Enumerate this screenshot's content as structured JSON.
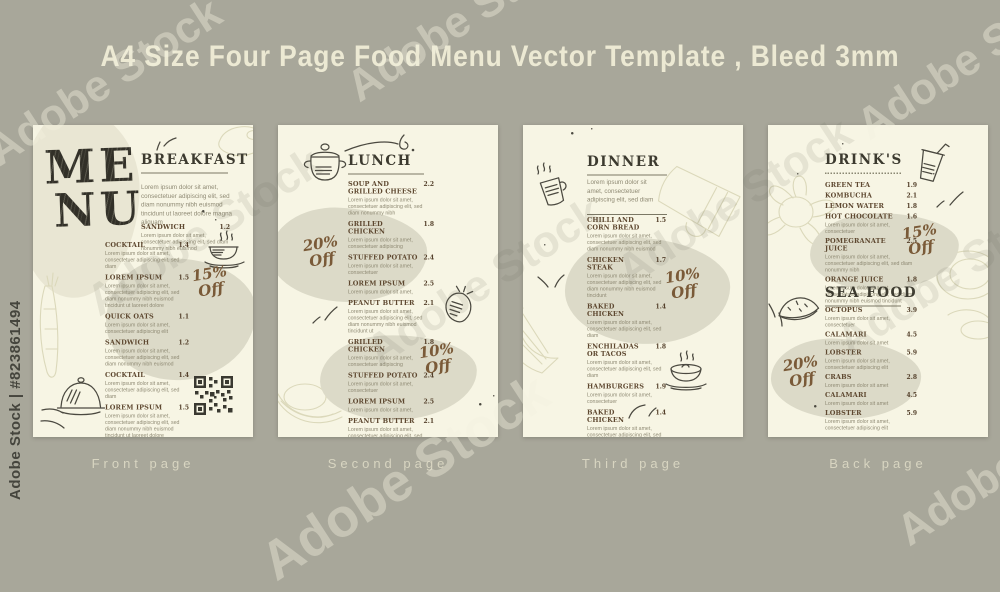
{
  "title": "A4 Size Four Page Food Menu Vector Template , Bleed 3mm",
  "watermark": {
    "stock_id": "Adobe Stock | #823861494",
    "brand": "Adobe Stock"
  },
  "colors": {
    "background": "#a8a79a",
    "page": "#f7f5e4",
    "blob_gray": "#dcdac8",
    "blob_beige": "#e9e6d3",
    "heading": "#3c3a2f",
    "item_name": "#5e4830",
    "body_text": "#8f8a74",
    "handwriting": "#7a5a38",
    "footer_label": "#d8d5c1"
  },
  "footer": {
    "labels": [
      "Front page",
      "Second page",
      "Third page",
      "Back page"
    ]
  },
  "pages": {
    "front": {
      "menu_word": {
        "line1": "ME",
        "line2": "NU"
      },
      "heading": "BREAKFAST",
      "intro": "Lorem ipsum dolor sit amet, consectetuer adipiscing elit, sed diam nonummy nibh euismod tincidunt ut laoreet dolore magna aliquam",
      "discount": {
        "percent": "15%",
        "word": "Off"
      },
      "items": [
        {
          "name": "SANDWICH",
          "price": "1.2",
          "desc": "Lorem ipsum dolor sit amet, consectetuer adipiscing elit, sed diam nonummy nibh euismod"
        },
        {
          "name": "COCKTAIL",
          "price": "1.4",
          "desc": "Lorem ipsum dolor sit amet, consectetuer adipiscing elit, sed diam"
        },
        {
          "name": "LOREM IPSUM",
          "price": "1.5",
          "desc": "Lorem ipsum dolor sit amet, consectetuer adipiscing elit, sed diam nonummy nibh euismod tincidunt ut laoreet dolore"
        },
        {
          "name": "QUICK OATS",
          "price": "1.1",
          "desc": "Lorem ipsum dolor sit amet, consectetuer adipiscing elit"
        },
        {
          "name": "SANDWICH",
          "price": "1.2",
          "desc": "Lorem ipsum dolor sit amet, consectetuer adipiscing elit, sed diam nonummy nibh euismod"
        },
        {
          "name": "COCKTAIL",
          "price": "1.4",
          "desc": "Lorem ipsum dolor sit amet, consectetuer adipiscing elit, sed diam"
        },
        {
          "name": "LOREM IPSUM",
          "price": "1.5",
          "desc": "Lorem ipsum dolor sit amet, consectetuer adipiscing elit, sed diam nonummy nibh euismod tincidunt ut laoreet dolore"
        },
        {
          "name": "QUICK OATS",
          "price": "1.1",
          "desc": "Lorem ipsum dolor sit amet, consectetuer adipiscing elit"
        }
      ],
      "icons": [
        "leaf-marks",
        "coffee-cup",
        "carrot-sketch",
        "cloche",
        "swoosh-marks",
        "qr-code",
        "plate-sketch"
      ]
    },
    "second": {
      "heading": "LUNCH",
      "discount_top": {
        "percent": "20%",
        "word": "Off"
      },
      "discount_bottom": {
        "percent": "10%",
        "word": "Off"
      },
      "items": [
        {
          "name": "SOUP AND GRILLED CHEESE",
          "price": "2.2",
          "desc": "Lorem ipsum dolor sit amet, consectetuer adipiscing elit, sed diam nonummy nibh"
        },
        {
          "name": "GRILLED CHICKEN",
          "price": "1.8",
          "desc": "Lorem ipsum dolor sit amet, consectetuer adipiscing"
        },
        {
          "name": "STUFFED POTATO",
          "price": "2.4",
          "desc": "Lorem ipsum dolor sit amet, consectetuer"
        },
        {
          "name": "LOREM IPSUM",
          "price": "2.5",
          "desc": "Lorem ipsum dolor sit amet,"
        },
        {
          "name": "PEANUT BUTTER",
          "price": "2.1",
          "desc": "Lorem ipsum dolor sit amet, consectetuer adipiscing elit, sed diam nonummy nibh euismod tincidunt ut"
        },
        {
          "name": "GRILLED CHICKEN",
          "price": "1.8",
          "desc": "Lorem ipsum dolor sit amet, consectetuer adipiscing"
        },
        {
          "name": "STUFFED POTATO",
          "price": "2.4",
          "desc": "Lorem ipsum dolor sit amet, consectetuer"
        },
        {
          "name": "LOREM IPSUM",
          "price": "2.5",
          "desc": "Lorem ipsum dolor sit amet,"
        },
        {
          "name": "PEANUT BUTTER",
          "price": "2.1",
          "desc": "Lorem ipsum dolor sit amet, consectetuer adipiscing elit, sed diam nonummy nibh euismod tincidunt ut"
        },
        {
          "name": "STUFFED POTATO",
          "price": "2.4",
          "desc": "Lorem ipsum dolor sit amet, consectetuer"
        }
      ],
      "icons": [
        "cooking-pot",
        "scribble",
        "strawberry",
        "leaf-marks",
        "banana-sketch"
      ]
    },
    "third": {
      "heading": "DINNER",
      "intro": "Lorem ipsum dolor sit amet, consectetuer adipiscing elit, sed diam",
      "discount": {
        "percent": "10%",
        "word": "Off"
      },
      "items": [
        {
          "name": "CHILLI AND CORN BREAD",
          "price": "1.5",
          "desc": "Lorem ipsum dolor sit amet, consectetuer adipiscing elit, sed diam nonummy nibh euismod"
        },
        {
          "name": "CHICKEN STEAK",
          "price": "1.7",
          "desc": "Lorem ipsum dolor sit amet, consectetuer adipiscing elit, sed diam nonummy nibh euismod tincidunt"
        },
        {
          "name": "BAKED CHICKEN",
          "price": "1.4",
          "desc": "Lorem ipsum dolor sit amet, consectetuer adipiscing elit, sed diam"
        },
        {
          "name": "ENCHILADAS OR TACOS",
          "price": "1.8",
          "desc": "Lorem ipsum dolor sit amet, consectetuer adipiscing elit, sed diam"
        },
        {
          "name": "HAMBURGERS",
          "price": "1.9",
          "desc": "Lorem ipsum dolor sit amet, consectetuer"
        },
        {
          "name": "BAKED CHICKEN",
          "price": "1.4",
          "desc": "Lorem ipsum dolor sit amet, consectetuer adipiscing elit, sed diam"
        },
        {
          "name": "ENCHILADAS OR TACOS",
          "price": "1.8",
          "desc": "Lorem ipsum dolor sit amet, consectetuer adipiscing elit, sed diam"
        }
      ],
      "icons": [
        "steaming-mug",
        "mug-sketch",
        "lemon-sketch",
        "teacup",
        "check-marks",
        "swoosh-marks"
      ]
    },
    "back": {
      "drinks_heading": "DRINK'S",
      "seafood_heading": "SEA FOOD",
      "discount_drinks": {
        "percent": "15%",
        "word": "Off"
      },
      "discount_seafood": {
        "percent": "20%",
        "word": "Off"
      },
      "drinks_items": [
        {
          "name": "GREEN TEA",
          "price": "1.9"
        },
        {
          "name": "KOMBUCHA",
          "price": "2.1"
        },
        {
          "name": "LEMON WATER",
          "price": "1.8"
        },
        {
          "name": "HOT CHOCOLATE",
          "price": "1.6",
          "desc": "Lorem ipsum dolor sit amet, consectetuer"
        },
        {
          "name": "POMEGRANATE JUICE",
          "price": "2.5",
          "desc": "Lorem ipsum dolor sit amet, consectetuer adipiscing elit, sed diam nonummy nibh"
        },
        {
          "name": "ORANGE JUICE",
          "price": "1.8",
          "desc": "Lorem ipsum dolor sit amet, consectetuer adipiscing elit, sed diam nonummy nibh euismod tincidunt"
        }
      ],
      "seafood_items": [
        {
          "name": "OCTOPUS",
          "price": "3.9",
          "desc": "Lorem ipsum dolor sit amet, consectetuer"
        },
        {
          "name": "CALAMARI",
          "price": "4.5",
          "desc": "Lorem ipsum dolor sit amet"
        },
        {
          "name": "LOBSTER",
          "price": "5.9",
          "desc": "Lorem ipsum dolor sit amet, consectetuer adipiscing elit"
        },
        {
          "name": "CRABS",
          "price": "2.8",
          "desc": "Lorem ipsum dolor sit amet"
        },
        {
          "name": "CALAMARI",
          "price": "4.5",
          "desc": "Lorem ipsum dolor sit amet"
        },
        {
          "name": "LOBSTER",
          "price": "5.9",
          "desc": "Lorem ipsum dolor sit amet, consectetuer adipiscing elit"
        }
      ],
      "icons": [
        "drink-cup-straw",
        "flower-sketch",
        "watermelon",
        "plate-sketch",
        "leaf-marks"
      ]
    }
  }
}
